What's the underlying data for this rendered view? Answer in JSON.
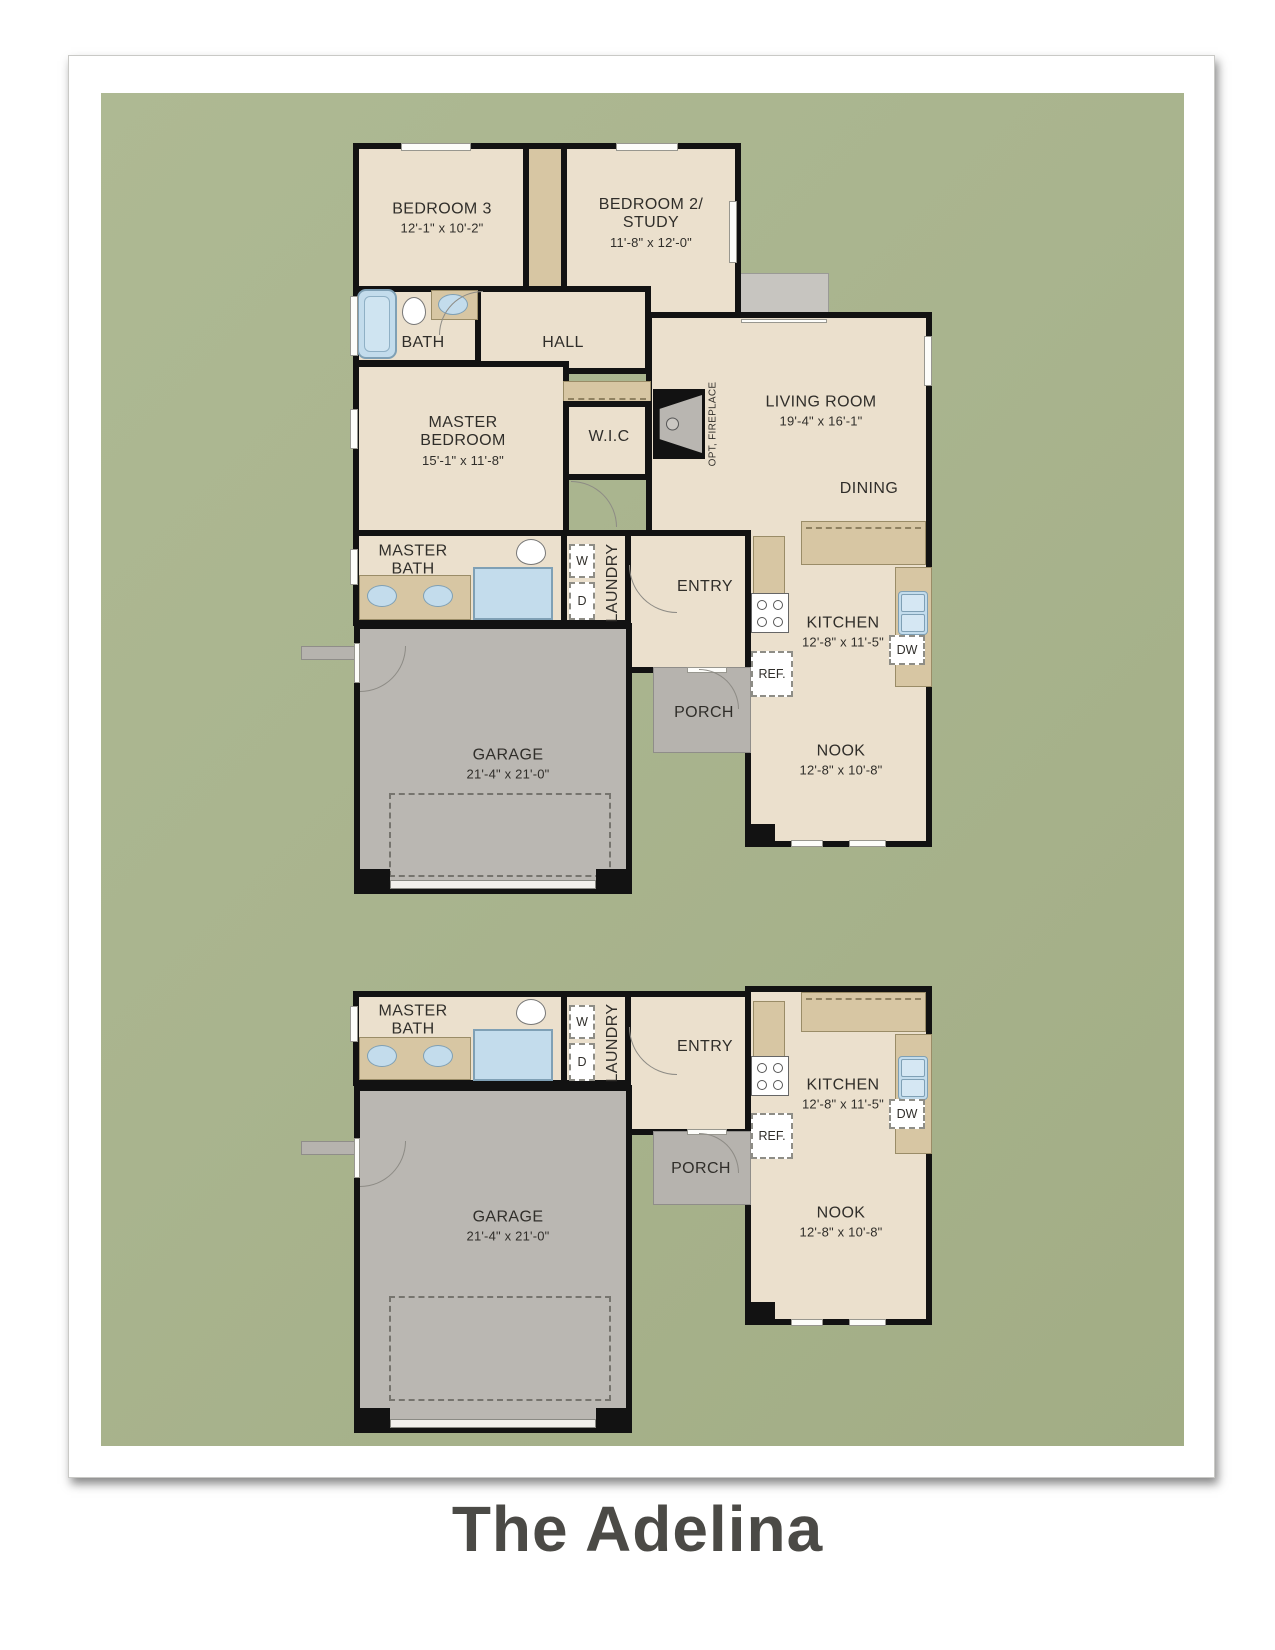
{
  "title": "The Adelina",
  "colors": {
    "canvas_green": "#a9b48e",
    "floor_beige": "#ebe0cd",
    "counter_tan": "#d7c6a3",
    "wall_black": "#121212",
    "garage_gray": "#bab7b2",
    "fixture_blue": "#c3dcec",
    "title_color": "#4b4a46"
  },
  "plan_top": {
    "bedroom3": {
      "name": "BEDROOM 3",
      "dims": "12'-1\" x 10'-2\""
    },
    "bedroom2": {
      "name": "BEDROOM 2/\nSTUDY",
      "dims": "11'-8\" x 12'-0\""
    },
    "bath": {
      "name": "BATH"
    },
    "hall": {
      "name": "HALL"
    },
    "living": {
      "name": "LIVING ROOM",
      "dims": "19'-4\" x 16'-1\""
    },
    "dining": {
      "name": "DINING"
    },
    "master_bedroom": {
      "name": "MASTER\nBEDROOM",
      "dims": "15'-1\" x 11'-8\""
    },
    "wic": {
      "name": "W.I.C"
    },
    "fireplace": {
      "name": "OPT, FIREPLACE"
    },
    "master_bath": {
      "name": "MASTER\nBATH"
    },
    "laundry": {
      "name": "LAUNDRY",
      "washer": "W",
      "dryer": "D"
    },
    "entry": {
      "name": "ENTRY"
    },
    "kitchen": {
      "name": "KITCHEN",
      "dims": "12'-8\" x 11'-5\"",
      "dw": "DW",
      "ref": "REF."
    },
    "porch": {
      "name": "PORCH"
    },
    "garage": {
      "name": "GARAGE",
      "dims": "21'-4\" x 21'-0\""
    },
    "nook": {
      "name": "NOOK",
      "dims": "12'-8\" x 10'-8\""
    }
  },
  "plan_bottom": {
    "master_bath": {
      "name": "MASTER\nBATH"
    },
    "laundry": {
      "name": "LAUNDRY",
      "washer": "W",
      "dryer": "D"
    },
    "entry": {
      "name": "ENTRY"
    },
    "kitchen": {
      "name": "KITCHEN",
      "dims": "12'-8\" x 11'-5\"",
      "dw": "DW",
      "ref": "REF."
    },
    "porch": {
      "name": "PORCH"
    },
    "garage": {
      "name": "GARAGE",
      "dims": "21'-4\" x 21'-0\""
    },
    "nook": {
      "name": "NOOK",
      "dims": "12'-8\" x 10'-8\""
    }
  }
}
